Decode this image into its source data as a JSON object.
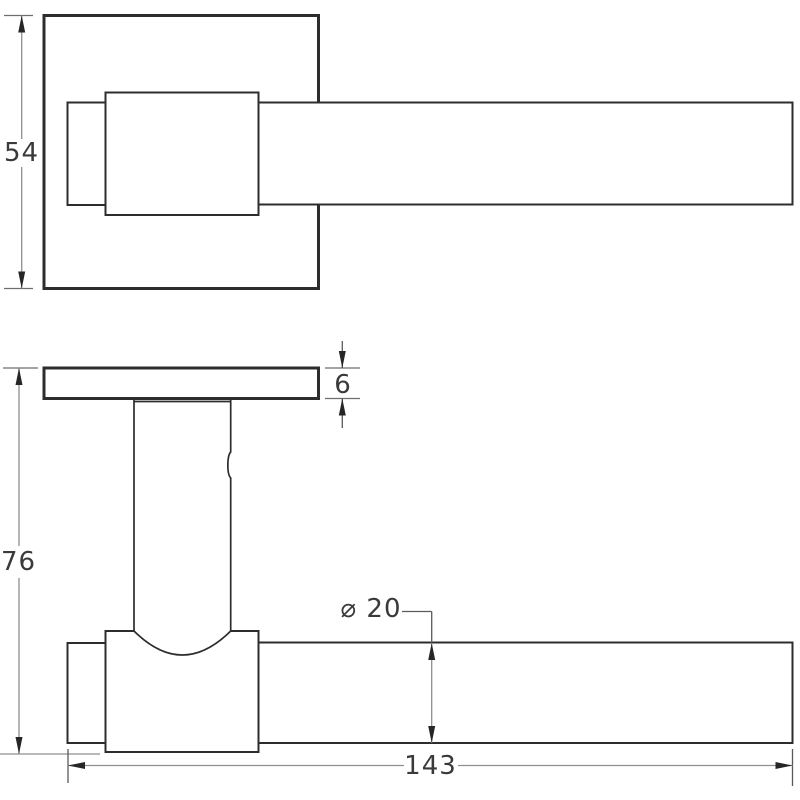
{
  "dimensions": {
    "rose_size": "54",
    "overall_projection": "76",
    "rose_thickness": "6",
    "bar_diameter": "⌀ 20",
    "overall_length": "143"
  },
  "colors": {
    "background": "#ffffff",
    "object_line": "#2d2d2d",
    "dimension_line": "#8f8f8f",
    "extension_line": "#6e6e6e",
    "leader_line": "#5a5a5a",
    "arrow": "#262626",
    "text": "#3a3a3a"
  }
}
